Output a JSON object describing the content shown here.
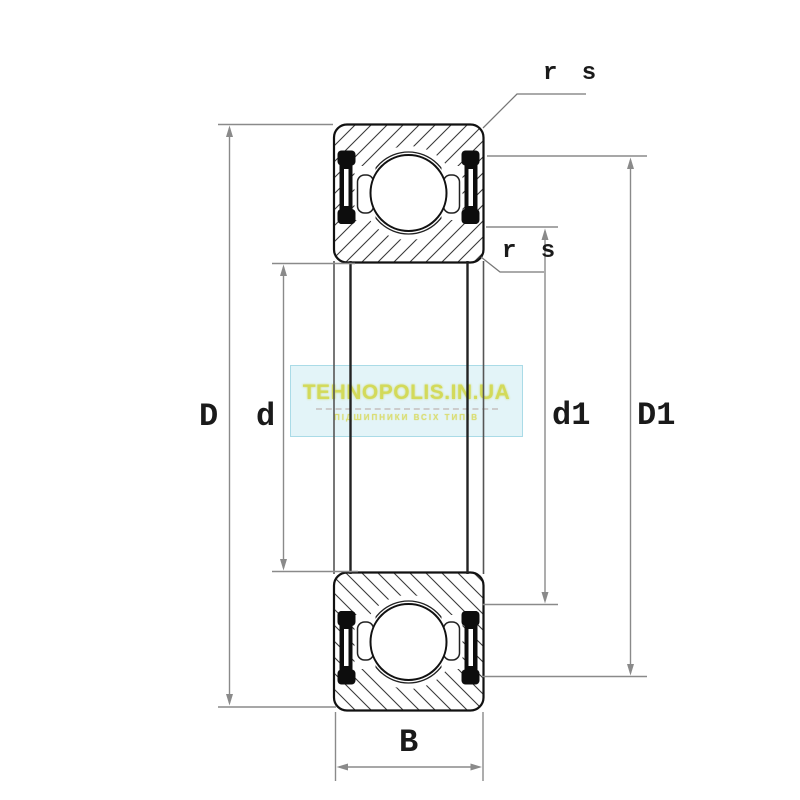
{
  "diagram": {
    "type": "deep-groove-ball-bearing-sealed-cross-section",
    "labels": {
      "outer_diameter": "D",
      "bore_diameter": "d",
      "inner_shoulder_diameter": "d1",
      "outer_shoulder_diameter": "D1",
      "width": "B",
      "chamfer_top": "r s",
      "chamfer_mid": "r s"
    },
    "colors": {
      "outline": "#111111",
      "hatch": "#3a3a3a",
      "seal": "#0d0d0d",
      "dimension": "#8a8a8a",
      "leader": "#777777"
    }
  },
  "watermark": {
    "title": "TEHNOPOLIS.IN.UA",
    "subtitle": "ПІДШИПНИКИ ВСІХ ТИПІВ",
    "title_color": "#d3da5a",
    "box_color": "#dbf1f6"
  }
}
